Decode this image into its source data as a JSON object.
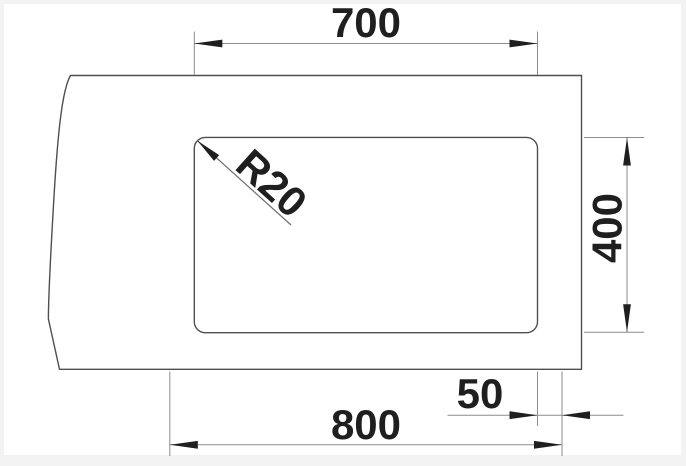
{
  "drawing": {
    "labels": {
      "bowl_width": "700",
      "bowl_depth": "400",
      "cabinet_width": "800",
      "side_clearance": "50",
      "corner_radius": "R20"
    },
    "colors": {
      "background": "#f3f3f3",
      "canvas": "#ffffff",
      "outline": "#4f4f4f",
      "dimension_line": "#8c8c8c",
      "annotation": "#1f1f1f"
    }
  }
}
